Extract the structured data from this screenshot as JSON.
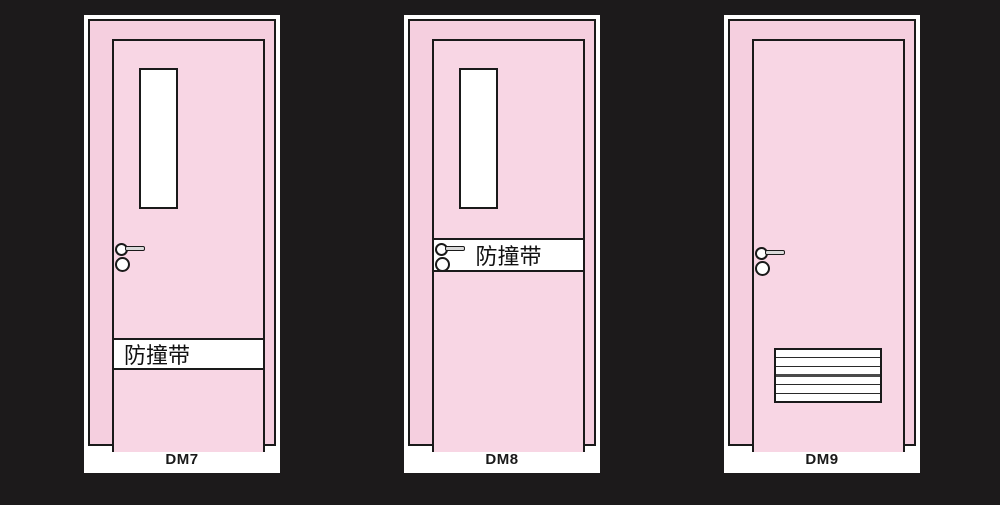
{
  "diagram_title": "door-styles-catalog",
  "colors": {
    "background": "#1c1a1b",
    "card": "#ffffff",
    "frame_pink": "#f5cfdf",
    "leaf_pink": "#f8d6e4",
    "outline": "#1a1a1a",
    "bump_strip_bg": "#ffffff",
    "handle_bar": "#d9d9d9"
  },
  "doors": [
    {
      "id": "DM7",
      "label": "DM7",
      "has_window": true,
      "has_bump_strip": true,
      "bump_strip_text": "防撞带",
      "bump_strip_position": "lower",
      "has_handle": true,
      "has_vent": false
    },
    {
      "id": "DM8",
      "label": "DM8",
      "has_window": true,
      "has_bump_strip": true,
      "bump_strip_text": "防撞带",
      "bump_strip_position": "middle",
      "has_handle": true,
      "has_vent": false
    },
    {
      "id": "DM9",
      "label": "DM9",
      "has_window": false,
      "has_bump_strip": false,
      "bump_strip_text": "",
      "bump_strip_position": "none",
      "has_handle": true,
      "has_vent": true
    }
  ]
}
